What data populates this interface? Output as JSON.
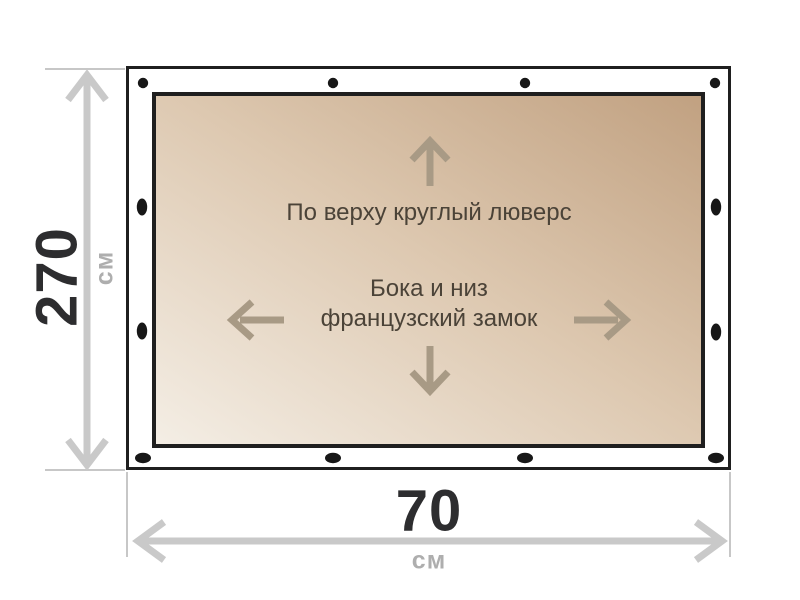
{
  "diagram": {
    "surface": {
      "top_note": "По верху круглый люверс",
      "middle_note_line1": "Бока и низ",
      "middle_note_line2": "французский замок"
    },
    "height_dimension": {
      "value": "270",
      "unit": "см"
    },
    "width_dimension": {
      "value": "70",
      "unit": "см"
    },
    "icons": {
      "up": "up-arrow-icon",
      "down": "down-arrow-icon",
      "left": "left-arrow-icon",
      "right": "right-arrow-icon",
      "grommet": "grommet-dot"
    },
    "colors": {
      "frame_stroke": "#1f1f1f",
      "tarp_light": "#f4eee5",
      "tarp_dark": "#c1a181",
      "inner_arrow": "#a89a85",
      "note_text": "#4b4338",
      "dimension_value": "#2d2d2f",
      "dimension_unit": "#aeaeae",
      "dimension_line": "#c9c9c9",
      "grommet_fill": "#171717"
    }
  }
}
